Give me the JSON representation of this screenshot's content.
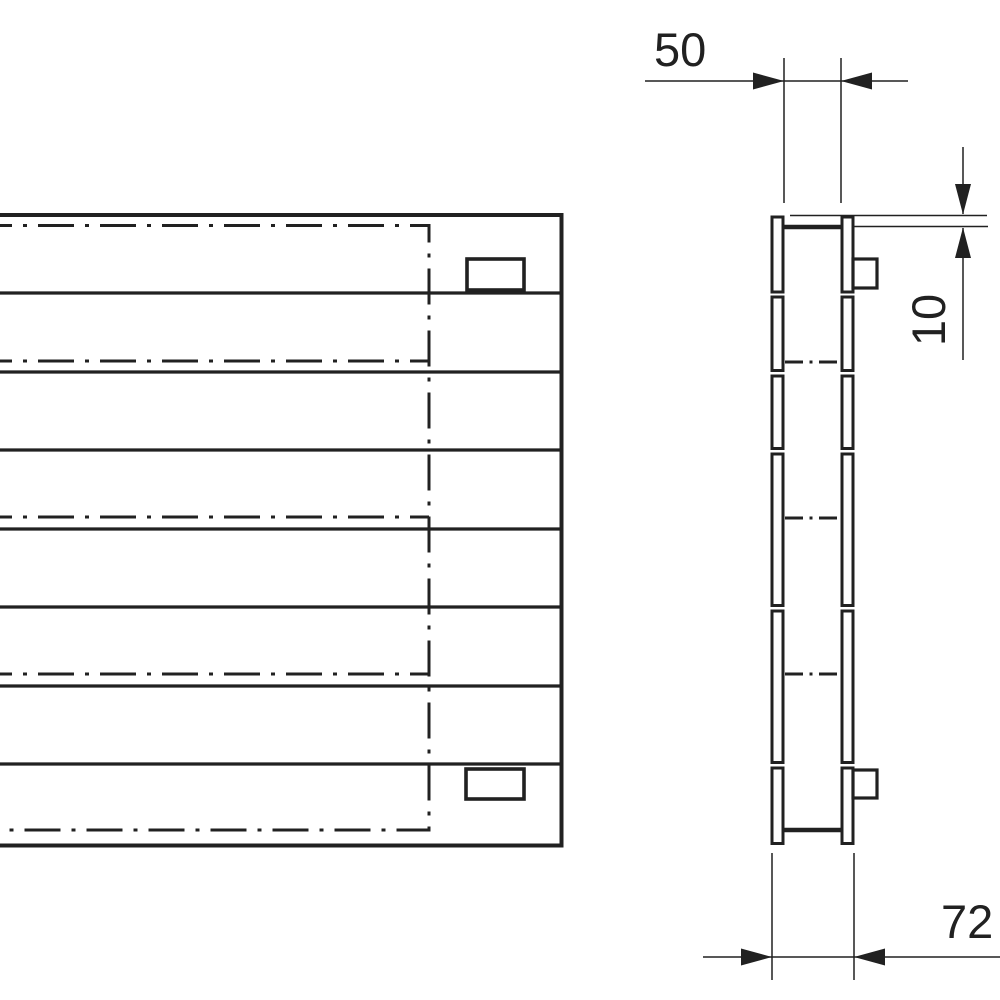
{
  "page": {
    "background": "#ffffff",
    "line_color": "#212121"
  },
  "drawing": {
    "type": "technical-drawing",
    "views": {
      "front_view": {
        "bands": 8,
        "centerlines": 5,
        "brackets": 2
      },
      "side_view": {
        "rails": 2,
        "segments_per_rail": 6,
        "centerlines": 3,
        "brackets": 2
      }
    },
    "dimensions": {
      "gap_width": {
        "label": "50",
        "orientation": "horizontal"
      },
      "top_offset": {
        "label": "10",
        "orientation": "vertical"
      },
      "depth": {
        "label": "72",
        "orientation": "horizontal"
      }
    }
  }
}
